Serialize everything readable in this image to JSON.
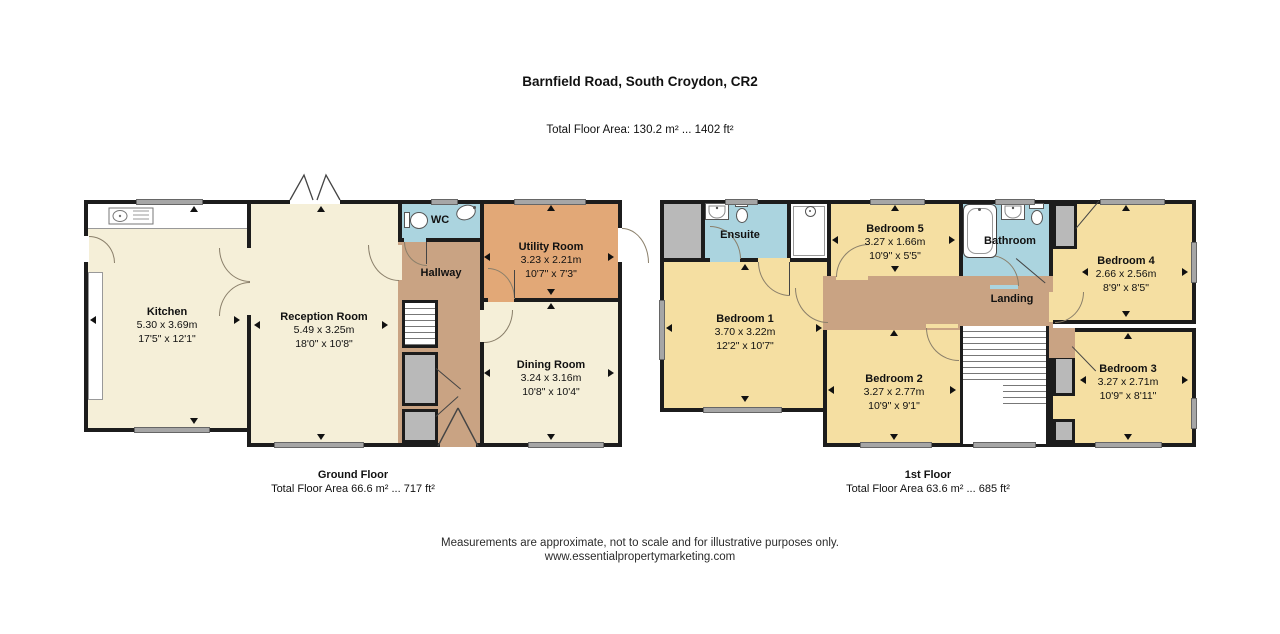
{
  "title": "Barnfield Road, South Croydon, CR2",
  "subtitle": "Total Floor Area: 130.2 m² ... 1402 ft²",
  "footer": {
    "disclaimer": "Measurements are approximate, not to scale and for illustrative purposes only.",
    "website": "www.essentialpropertymarketing.com"
  },
  "palette": {
    "wall": "#1c1c1c",
    "ground_room": "#f5efd8",
    "bedroom": "#f5dfa2",
    "hall_landing": "#c9a383",
    "utility": "#e2a877",
    "bathroom": "#abd4df",
    "window": "#a6a6a6",
    "closet": "#b9b9b9"
  },
  "floors": [
    {
      "label": "Ground Floor",
      "area": "Total Floor Area 66.6 m² ... 717 ft²",
      "rooms": {
        "kitchen": {
          "name": "Kitchen",
          "metric": "5.30 x 3.69m",
          "imperial": "17'5\" x 12'1\""
        },
        "reception": {
          "name": "Reception Room",
          "metric": "5.49 x 3.25m",
          "imperial": "18'0\" x 10'8\""
        },
        "hallway": {
          "name": "Hallway"
        },
        "wc": {
          "name": "WC"
        },
        "utility": {
          "name": "Utility Room",
          "metric": "3.23 x 2.21m",
          "imperial": "10'7\" x 7'3\""
        },
        "dining": {
          "name": "Dining Room",
          "metric": "3.24 x 3.16m",
          "imperial": "10'8\" x 10'4\""
        }
      }
    },
    {
      "label": "1st Floor",
      "area": "Total Floor Area 63.6 m² ... 685 ft²",
      "rooms": {
        "bedroom1": {
          "name": "Bedroom 1",
          "metric": "3.70 x 3.22m",
          "imperial": "12'2\" x 10'7\""
        },
        "bedroom2": {
          "name": "Bedroom 2",
          "metric": "3.27 x 2.77m",
          "imperial": "10'9\" x 9'1\""
        },
        "bedroom3": {
          "name": "Bedroom 3",
          "metric": "3.27 x 2.71m",
          "imperial": "10'9\" x 8'11\""
        },
        "bedroom4": {
          "name": "Bedroom 4",
          "metric": "2.66 x 2.56m",
          "imperial": "8'9\" x 8'5\""
        },
        "bedroom5": {
          "name": "Bedroom 5",
          "metric": "3.27 x 1.66m",
          "imperial": "10'9\" x 5'5\""
        },
        "ensuite": {
          "name": "Ensuite"
        },
        "bathroom": {
          "name": "Bathroom"
        },
        "landing": {
          "name": "Landing"
        }
      }
    }
  ]
}
